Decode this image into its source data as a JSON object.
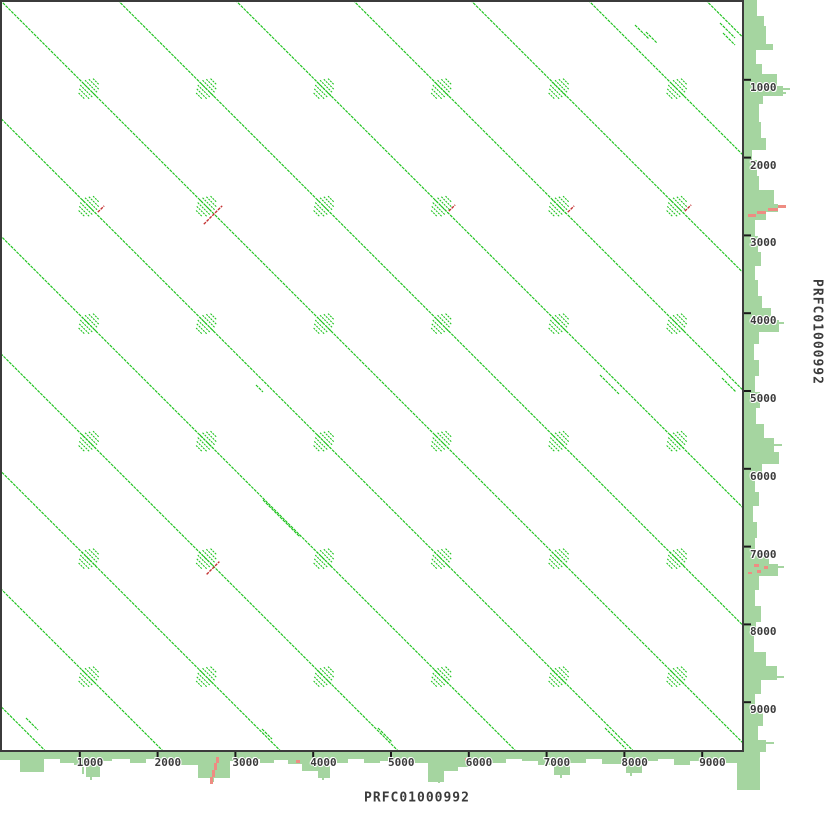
{
  "axes": {
    "x_title": "PRFC01000992",
    "y_title": "PRFC01000992",
    "x_tick_labels": [
      "1000",
      "2000",
      "3000",
      "4000",
      "5000",
      "6000",
      "7000",
      "8000",
      "9000"
    ],
    "y_tick_labels": [
      "1000",
      "2000",
      "3000",
      "4000",
      "5000",
      "6000",
      "7000",
      "8000",
      "9000"
    ],
    "tick_values": [
      1000,
      2000,
      3000,
      4000,
      5000,
      6000,
      7000,
      8000,
      9000
    ]
  },
  "chart_data": {
    "type": "scatter",
    "subtype": "sequence-self-dotplot",
    "title": "Self dotplot of PRFC01000992 vs PRFC01000992",
    "xlabel": "PRFC01000992",
    "ylabel": "PRFC01000992",
    "xlim": [
      0,
      9540
    ],
    "ylim": [
      0,
      9540
    ],
    "grid": false,
    "legend_position": "none",
    "repeat_period_bp": 1510,
    "forward_diagonal_offsets_bp": [
      -9060,
      -7550,
      -6040,
      -4530,
      -3020,
      -1510,
      0,
      1510,
      3020,
      4530,
      6040,
      7550,
      9060
    ],
    "tandem_repeat_cluster_centers_bp": [
      1120,
      2630,
      4140,
      5650,
      7160,
      8680
    ],
    "inverted_match_points_bp": [
      {
        "x": 1270,
        "y": 2660
      },
      {
        "x": 2710,
        "y": 2740
      },
      {
        "x": 5780,
        "y": 2650
      },
      {
        "x": 7310,
        "y": 2660
      },
      {
        "x": 8820,
        "y": 2650
      },
      {
        "x": 2710,
        "y": 7280
      }
    ],
    "edge_profiles": "light-green coverage/identity histograms drawn along right and bottom axes with salmon-red low-identity marks near bp 2700 and bp 7200"
  },
  "colors": {
    "match_green": "#1ec21e",
    "histogram_green": "#a5d5a0",
    "inverted_red": "#c43333",
    "salmon": "#ee8c82",
    "border": "#3b3b3b",
    "tick": "#1a1a1a",
    "text": "#3b3b3b",
    "background": "#ffffff"
  },
  "geometry": {
    "scale_px_per_bp": 0.0778,
    "origin_px": 2,
    "plot_box_px": {
      "left": 0,
      "top": 0,
      "width": 744,
      "height": 752
    },
    "diagonal_offsets_px": [
      -705.6,
      -588,
      -470.4,
      -352.8,
      -235.2,
      -117.6,
      0,
      117.6,
      235.2,
      352.8,
      470.4,
      588,
      705.6
    ],
    "blob_grid_px": [
      89,
      206.5,
      324,
      441.5,
      559,
      677
    ],
    "blob_line_lengths": [
      9,
      14,
      18,
      20,
      18,
      14,
      9
    ],
    "blob_line_spacing": 2.4,
    "red_marks_px": [
      {
        "cx": 101,
        "cy": 209,
        "len": 9
      },
      {
        "cx": 213,
        "cy": 215,
        "len": 26
      },
      {
        "cx": 452,
        "cy": 208,
        "len": 9
      },
      {
        "cx": 571,
        "cy": 209,
        "len": 9
      },
      {
        "cx": 688,
        "cy": 208,
        "len": 9
      },
      {
        "cx": 213,
        "cy": 568,
        "len": 18
      }
    ],
    "fragments_px": [
      {
        "x": 635,
        "y": 25,
        "len": 14
      },
      {
        "x": 646,
        "y": 32,
        "len": 11
      },
      {
        "x": 720,
        "y": 23,
        "len": 15
      },
      {
        "x": 723,
        "y": 33,
        "len": 12
      },
      {
        "x": 600,
        "y": 375,
        "len": 19
      },
      {
        "x": 722,
        "y": 378,
        "len": 14
      },
      {
        "x": 256,
        "y": 385,
        "len": 7
      },
      {
        "x": 263,
        "y": 500,
        "len": 37
      },
      {
        "x": 26,
        "y": 718,
        "len": 12
      },
      {
        "x": 378,
        "y": 728,
        "len": 14
      },
      {
        "x": 605,
        "y": 728,
        "len": 21
      },
      {
        "x": 262,
        "y": 729,
        "len": 10
      }
    ],
    "right_hist_segments": [
      [
        0,
        16,
        13
      ],
      [
        16,
        26,
        20
      ],
      [
        26,
        44,
        22
      ],
      [
        44,
        50,
        29
      ],
      [
        50,
        64,
        12
      ],
      [
        64,
        74,
        18
      ],
      [
        74,
        86,
        33
      ],
      [
        86,
        96,
        39
      ],
      [
        96,
        104,
        19
      ],
      [
        104,
        122,
        15
      ],
      [
        122,
        138,
        17
      ],
      [
        138,
        150,
        22
      ],
      [
        150,
        160,
        8
      ],
      [
        160,
        176,
        13
      ],
      [
        176,
        190,
        15
      ],
      [
        190,
        204,
        30
      ],
      [
        204,
        212,
        34
      ],
      [
        212,
        220,
        22
      ],
      [
        220,
        236,
        11
      ],
      [
        236,
        252,
        14
      ],
      [
        252,
        266,
        17
      ],
      [
        266,
        280,
        11
      ],
      [
        280,
        296,
        14
      ],
      [
        296,
        308,
        18
      ],
      [
        308,
        320,
        27
      ],
      [
        320,
        332,
        35
      ],
      [
        332,
        344,
        15
      ],
      [
        344,
        360,
        10
      ],
      [
        360,
        376,
        15
      ],
      [
        376,
        392,
        11
      ],
      [
        392,
        408,
        16
      ],
      [
        408,
        424,
        12
      ],
      [
        424,
        438,
        20
      ],
      [
        438,
        452,
        30
      ],
      [
        452,
        464,
        35
      ],
      [
        464,
        476,
        18
      ],
      [
        476,
        492,
        11
      ],
      [
        492,
        506,
        15
      ],
      [
        506,
        522,
        9
      ],
      [
        522,
        538,
        13
      ],
      [
        538,
        552,
        11
      ],
      [
        552,
        564,
        25
      ],
      [
        564,
        576,
        34
      ],
      [
        576,
        590,
        15
      ],
      [
        590,
        606,
        11
      ],
      [
        606,
        622,
        17
      ],
      [
        622,
        636,
        12
      ],
      [
        636,
        652,
        10
      ],
      [
        652,
        666,
        22
      ],
      [
        666,
        680,
        33
      ],
      [
        680,
        694,
        17
      ],
      [
        694,
        710,
        11
      ],
      [
        710,
        726,
        19
      ],
      [
        726,
        740,
        14
      ],
      [
        740,
        752,
        22
      ]
    ],
    "right_hist_spikes": [
      [
        88,
        46
      ],
      [
        92,
        42
      ],
      [
        206,
        38
      ],
      [
        322,
        40
      ],
      [
        444,
        38
      ],
      [
        566,
        40
      ],
      [
        676,
        40
      ],
      [
        742,
        30
      ]
    ],
    "right_salmon_rects": [
      [
        778,
        205,
        8,
        3
      ],
      [
        768,
        208,
        10,
        3
      ],
      [
        757,
        211,
        9,
        3
      ],
      [
        748,
        214,
        8,
        3
      ],
      [
        754,
        564,
        5,
        3
      ],
      [
        764,
        566,
        4,
        3
      ],
      [
        757,
        570,
        4,
        3
      ],
      [
        748,
        572,
        4,
        2
      ]
    ],
    "bottom_hist_segments": [
      [
        0,
        20,
        8
      ],
      [
        20,
        44,
        20
      ],
      [
        44,
        60,
        7
      ],
      [
        60,
        74,
        11
      ],
      [
        74,
        86,
        13
      ],
      [
        86,
        100,
        25
      ],
      [
        100,
        112,
        9
      ],
      [
        112,
        130,
        7
      ],
      [
        130,
        146,
        11
      ],
      [
        146,
        162,
        7
      ],
      [
        162,
        178,
        10
      ],
      [
        178,
        198,
        13
      ],
      [
        198,
        230,
        26
      ],
      [
        230,
        246,
        9
      ],
      [
        246,
        260,
        7
      ],
      [
        260,
        274,
        11
      ],
      [
        274,
        288,
        8
      ],
      [
        288,
        302,
        12
      ],
      [
        302,
        318,
        19
      ],
      [
        318,
        330,
        26
      ],
      [
        330,
        348,
        11
      ],
      [
        348,
        364,
        7
      ],
      [
        364,
        380,
        11
      ],
      [
        380,
        396,
        9
      ],
      [
        396,
        412,
        7
      ],
      [
        412,
        428,
        11
      ],
      [
        428,
        444,
        30
      ],
      [
        444,
        458,
        19
      ],
      [
        458,
        472,
        15
      ],
      [
        472,
        488,
        7
      ],
      [
        488,
        506,
        11
      ],
      [
        506,
        522,
        7
      ],
      [
        522,
        538,
        9
      ],
      [
        538,
        554,
        13
      ],
      [
        554,
        570,
        23
      ],
      [
        570,
        586,
        11
      ],
      [
        586,
        602,
        7
      ],
      [
        602,
        626,
        12
      ],
      [
        626,
        642,
        21
      ],
      [
        642,
        658,
        9
      ],
      [
        658,
        674,
        7
      ],
      [
        674,
        690,
        13
      ],
      [
        690,
        706,
        9
      ],
      [
        706,
        722,
        7
      ],
      [
        722,
        737,
        11
      ],
      [
        737,
        760,
        38
      ]
    ],
    "bottom_hist_spikes": [
      [
        82,
        22
      ],
      [
        90,
        28
      ],
      [
        95,
        24
      ],
      [
        212,
        30
      ],
      [
        322,
        28
      ],
      [
        438,
        31
      ],
      [
        560,
        26
      ],
      [
        630,
        24
      ]
    ],
    "bottom_salmon_rects": [
      [
        216,
        757,
        3,
        6
      ],
      [
        214,
        763,
        3,
        7
      ],
      [
        212,
        770,
        3,
        7
      ],
      [
        210,
        777,
        3,
        7
      ],
      [
        99,
        759,
        4,
        3
      ],
      [
        296,
        760,
        4,
        3
      ],
      [
        465,
        758,
        3,
        3
      ]
    ],
    "tick_len": 7
  }
}
